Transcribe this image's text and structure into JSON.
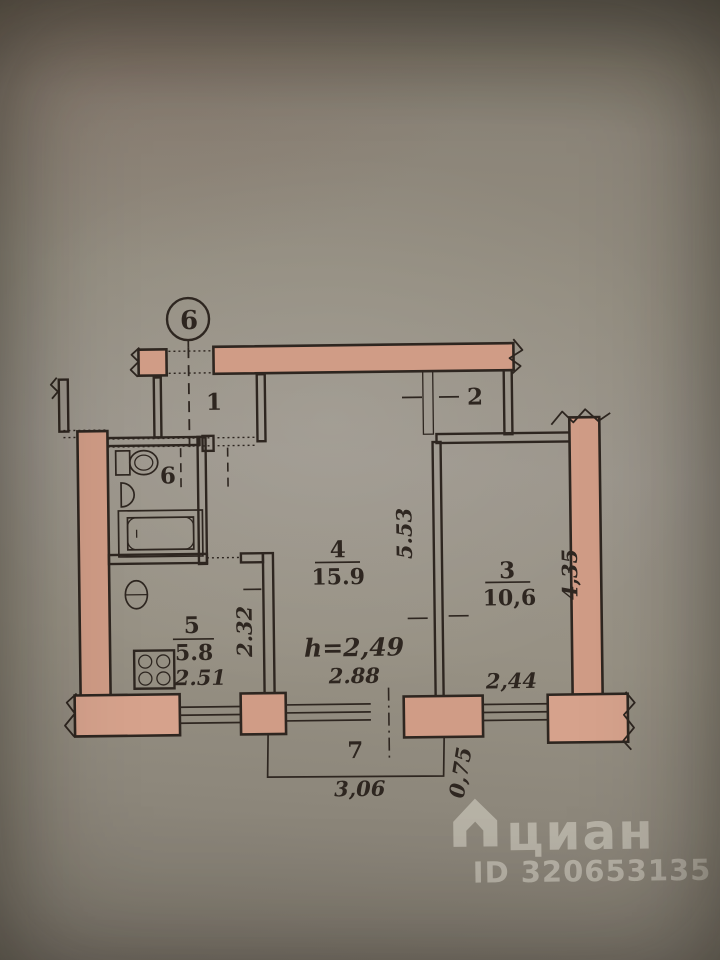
{
  "plan": {
    "section_mark": "6",
    "rooms": {
      "hall": {
        "number": "1"
      },
      "closet": {
        "number": "2"
      },
      "room3": {
        "number": "3",
        "area": "10,6"
      },
      "room4": {
        "number": "4",
        "area": "15.9"
      },
      "kitchen": {
        "number": "5",
        "area": "5.8"
      },
      "bathroom": {
        "number": "6"
      },
      "balcony": {
        "number": "7"
      }
    },
    "dimensions": {
      "room4_depth": "5.53",
      "room4_width": "2.88",
      "ceiling_height": "h=2,49",
      "room3_depth": "4,35",
      "room3_width": "2,44",
      "kitchen_width": "2.51",
      "kitchen_depth": "2.32",
      "balcony_width": "3,06",
      "balcony_depth": "0,75"
    }
  },
  "watermark": {
    "brand": "циан",
    "id_label": "ID 320653135"
  },
  "colors": {
    "wall_fill": "#d09c86",
    "wall_fill_light": "#d6a28c",
    "line": "#2e2620"
  }
}
